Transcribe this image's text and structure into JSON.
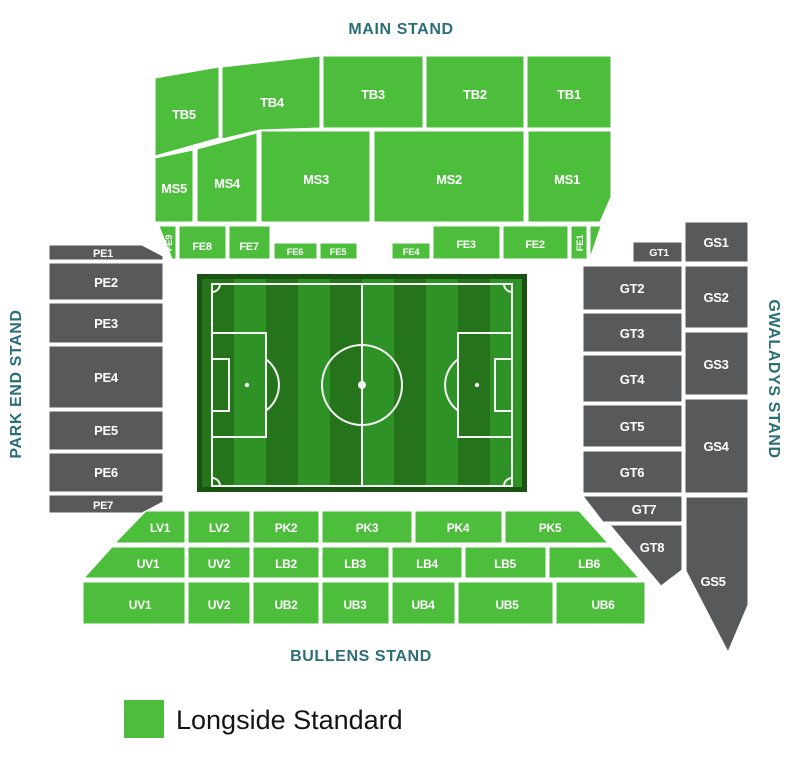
{
  "titles": {
    "main": "MAIN STAND",
    "park_end": "PARK END STAND",
    "gwaladys": "GWALADYS STAND",
    "bullens": "BULLENS STAND"
  },
  "legend": {
    "label": "Longside Standard",
    "swatch_color": "#4DBE3C"
  },
  "colors": {
    "section_available_green": "#4DBE3C",
    "section_unavailable_gray": "#58595A",
    "stand_title_teal": "#2C6E77",
    "section_text": "#FFFFFF",
    "pitch_stripe_light": "#2F9227",
    "pitch_stripe_dark": "#25741B",
    "pitch_border": "#1A5213",
    "pitch_line": "#F4F4F4"
  },
  "sections": {
    "tb": [
      "TB5",
      "TB4",
      "TB3",
      "TB2",
      "TB1"
    ],
    "ms": [
      "MS5",
      "MS4",
      "MS3",
      "MS2",
      "MS1"
    ],
    "fe": [
      "FE9",
      "FE8",
      "FE7",
      "FE6",
      "FE5",
      "FE4",
      "FE3",
      "FE2",
      "FE1"
    ],
    "pe": [
      "PE1",
      "PE2",
      "PE3",
      "PE4",
      "PE5",
      "PE6",
      "PE7"
    ],
    "gt": [
      "GT1",
      "GT2",
      "GT3",
      "GT4",
      "GT5",
      "GT6",
      "GT7",
      "GT8"
    ],
    "gs": [
      "GS1",
      "GS2",
      "GS3",
      "GS4",
      "GS5"
    ],
    "row1": [
      "LV1",
      "LV2",
      "PK2",
      "PK3",
      "PK4",
      "PK5"
    ],
    "row2": [
      "UV1",
      "UV2",
      "LB2",
      "LB3",
      "LB4",
      "LB5",
      "LB6"
    ],
    "row3": [
      "UV1",
      "UV2",
      "UB2",
      "UB3",
      "UB4",
      "UB5",
      "UB6"
    ]
  }
}
